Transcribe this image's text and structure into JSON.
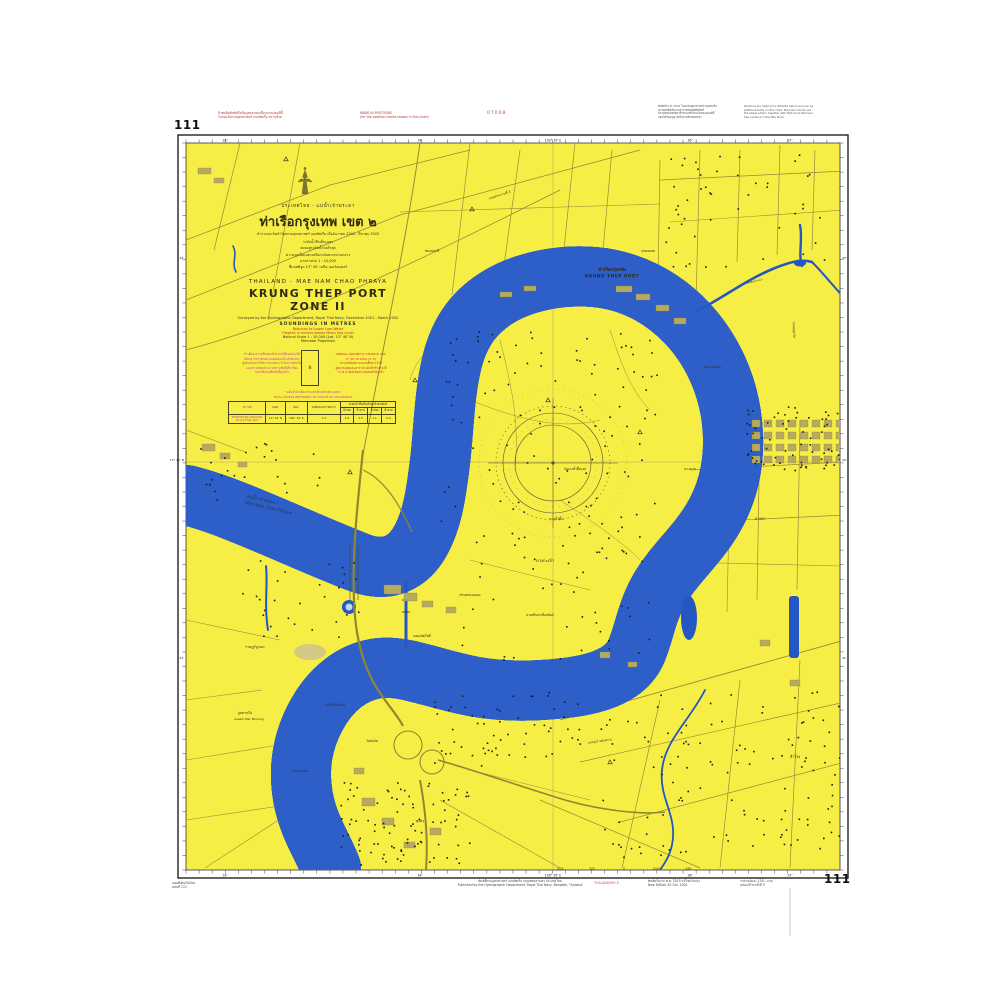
{
  "meta": {
    "chart_number": "111",
    "map_title": "Krung Thep Port Zone II nautical chart"
  },
  "margins": {
    "top": {
      "chart_number": "111",
      "red_note_left": [
        "ถ้าพบสิ่งพิมพ์หรือข้อมูลคลาดเคลื่อนจากแผนที่นี้",
        "โปรดแจ้งกรมอุทกศาสตร์ กองทัพเรือ ทราบด้วย"
      ],
      "red_note_right": [
        "MADE IN POSITIONS",
        "(for the position marks shown in this chart)"
      ],
      "magenta_code": "07008",
      "black_note_1": [
        "ลิขสิทธิ์ พ.ศ. 2545 โดยกรมอุทกศาสตร์ กองทัพเรือ",
        "สงวนลิขสิทธิ์ตามพระราชบัญญัติลิขสิทธิ์",
        "ห้ามคัดลอกหรือทำซ้ำส่วนหนึ่งส่วนใดของแผนที่นี้",
        "ก่อนได้รับอนุญาตเป็นลายลักษณ์อักษร"
      ],
      "black_note_2": [
        "Positions are referred to WGS-84 datum and can be",
        "plotted directly on this chart. Mariners should use",
        "the latest edition together with Notices to Mariners.",
        "See cautions in the title block."
      ]
    },
    "bottom": {
      "left": [
        "แผนที่เดินเรือไทย",
        "ฉบับที่ 111"
      ],
      "center": [
        "พิมพ์ที่กรมอุทกศาสตร์ กองทัพเรือ กรุงเทพมหานคร ประเทศไทย",
        "Published by the Hydrographic Department, Royal Thai Navy, Bangkok, Thailand"
      ],
      "magenta_code": "TH4-AN0099-5",
      "note_1": [
        "พิมพ์ครั้งแรก พ.ศ. 2515 แก้ไขปรับปรุง",
        "New Edition 30 Oct. 2002"
      ],
      "note_2": [
        "ราคาฉบับละ 150.- บาท",
        "ฉบับแก้ไข ครั้งที่ 5"
      ],
      "chart_number": "111"
    }
  },
  "title_block": {
    "thai_region": "ประเทศไทย - แม่น้ำเจ้าพระยา",
    "thai_title": "ท่าเรือกรุงเทพ เขต ๒",
    "thai_subtitle": "สำรวจและจัดทำโดยกรมอุทกศาสตร์ กองทัพเรือ เมื่อธันวาคม 2544 - มีนาคม 2545",
    "thai_lines": [
      "ระดับน้ำลึกเป็นเมตร",
      "ลดลงสู่ระดับน้ำลงต่ำสุด",
      "ความสูงเป็นเมตรเหนือระดับทะเลปานกลาง",
      "มาตราส่วน 1 : 10,000",
      "ที่แลตติจูด 13° 40' เหนือ  เมอร์เคเตอร์"
    ],
    "en_region": "THAILAND - MAE NAM CHAO PHRAYA",
    "en_title": "KRUNG THEP PORT ZONE II",
    "en_surveyed": "Surveyed by the Hydrographic Department, Royal Thai Navy, December 2001 - March 2002",
    "en_soundings": "SOUNDINGS IN METRES",
    "en_red_1": "Reduced to Lower Low Water",
    "en_red_2": "Heights in metres above Mean Sea Level",
    "en_scale": "Natural Scale 1 : 10,000 (Lat. 13° 40' N)",
    "en_projection": "Mercator Projection"
  },
  "caution_block": {
    "magenta_left": [
      "คำเตือน ความลึกของน้ำอาจเปลี่ยนแปลงได้",
      "เนื่องจากการตกตะกอนของแม่น้ำเจ้าพระยา",
      "ผู้เดินเรือควรใช้ความระมัดระวังในการเดินเรือ",
      "และตรวจสอบประกาศชาวเรือที่เกี่ยวข้อง",
      "ก่อนใช้แผนที่ฉบับนี้ทุกครั้ง"
    ],
    "red_right": [
      "ANNUAL  MAGNETIC  CHANGE  VAR.",
      "0° 35' W 2002  (2' E)",
      "ค่าแปรผันสนามแม่เหล็กประจำปี",
      "ดูหมายเหตุและตารางระดับน้ำข้างล่างนี้",
      "ระวัง สายเคเบิลและท่อลอดใต้แม่น้ำ"
    ],
    "magenta_caption_1": "ระดับน้ำอ้างอิงจากระดับน้ำลงต่ำสุด (เมตร)",
    "magenta_caption_2": "TIDAL LEVELS REFERRED TO DATUM OF SOUNDINGS"
  },
  "tide_table": {
    "headers_row1": [
      "สถานที่",
      "แลต.",
      "ลอง.",
      "ระดับทะเลปานกลาง",
      "ระดับน้ำขึ้นเต็มที่และน้ำลงเต็มที่"
    ],
    "headers_row2": [
      "น้ำเกิด",
      "น้ำตาย",
      "น้ำเกิด",
      "น้ำตาย"
    ],
    "row": [
      "ท่าเรือกรุงเทพ (คลองเตย) Krung Thep Port",
      "13° 42' N",
      "100° 34' E",
      "1.9",
      "2.8",
      "2.2",
      "1.1",
      "0.4"
    ]
  },
  "scale_bar": {
    "label_left": "มาตราส่วน 1 : 10,000",
    "ticks": [
      "1000",
      "500",
      "0",
      "1000",
      "เมตร"
    ]
  },
  "frame_ticks": {
    "top": [
      [
        225,
        "33'"
      ],
      [
        420,
        "34'"
      ],
      [
        553,
        "100° 35' E"
      ],
      [
        690,
        "36'"
      ],
      [
        790,
        "37'"
      ]
    ],
    "bottom": [
      [
        225,
        "33'"
      ],
      [
        420,
        "34'"
      ],
      [
        553,
        "100° 35' E"
      ],
      [
        690,
        "36'"
      ],
      [
        790,
        "37'"
      ]
    ],
    "left": [
      [
        260,
        "43'"
      ],
      [
        462,
        "13° 42' N"
      ],
      [
        660,
        "41'"
      ]
    ],
    "right": [
      [
        260,
        "43'"
      ],
      [
        462,
        "42'"
      ],
      [
        660,
        "41'"
      ]
    ]
  },
  "map_labels": [
    {
      "t": "ท่าเรือกรุงเทพ",
      "x": 612,
      "y": 271,
      "s": 4.6,
      "b": 1
    },
    {
      "t": "KRUNG THEP PORT",
      "x": 612,
      "y": 277.5,
      "s": 4.4,
      "b": 1,
      "sp": 0.5
    },
    {
      "t": "แม่น้ำเจ้าพระยา",
      "x": 262,
      "y": 501,
      "s": 4.6,
      "r": 13,
      "c": "#24304a"
    },
    {
      "t": "Mae Nam Chao Phraya",
      "x": 268,
      "y": 509,
      "s": 4.2,
      "r": 13,
      "i": 1,
      "c": "#24304a"
    },
    {
      "t": "บางกะเจ้า",
      "x": 545,
      "y": 562,
      "s": 4.2
    },
    {
      "t": "ตำบลทรงคนอง",
      "x": 470,
      "y": 596,
      "s": 3.2
    },
    {
      "t": "คลองลัดโพธิ์",
      "x": 422,
      "y": 637,
      "s": 3.2
    },
    {
      "t": "พระประแดง",
      "x": 335,
      "y": 706,
      "s": 3.8
    },
    {
      "t": "วัดบางน้ำผึ้งนอก",
      "x": 575,
      "y": 470,
      "s": 3.2
    },
    {
      "t": "บางน้ำผึ้ง",
      "x": 556,
      "y": 520,
      "s": 3.4
    },
    {
      "t": "ช่องนนทรี",
      "x": 432,
      "y": 252,
      "s": 3.4
    },
    {
      "t": "ถนนพระรามที่ 3",
      "x": 500,
      "y": 196,
      "s": 3.2,
      "r": -18
    },
    {
      "t": "คลองเตย",
      "x": 648,
      "y": 252,
      "s": 3.4
    },
    {
      "t": "ถนนสุขุมวิท",
      "x": 793,
      "y": 330,
      "s": 3.2,
      "r": 88
    },
    {
      "t": "บางนา",
      "x": 760,
      "y": 520,
      "s": 3.8
    },
    {
      "t": "สำโรง",
      "x": 795,
      "y": 758,
      "s": 3.8
    },
    {
      "t": "ราษฎร์บูรณะ",
      "x": 255,
      "y": 648,
      "s": 3.6
    },
    {
      "t": "บางปะกอก",
      "x": 300,
      "y": 772,
      "s": 3.4
    },
    {
      "t": "ทุ่งครุ",
      "x": 420,
      "y": 822,
      "s": 3.6
    },
    {
      "t": "บางจาก",
      "x": 690,
      "y": 470,
      "s": 3.4
    },
    {
      "t": "อู่ทหารเรือ",
      "x": 245,
      "y": 714,
      "s": 3.2
    },
    {
      "t": "Asiatic Pier Mooring",
      "x": 249,
      "y": 720,
      "s": 3.0,
      "i": 1
    },
    {
      "t": "วัดคันลัด",
      "x": 372,
      "y": 742,
      "s": 3.0
    },
    {
      "t": "สวนศรีนครเขื่อนขันธ์",
      "x": 540,
      "y": 616,
      "s": 3.0
    },
    {
      "t": "คลองบางนา",
      "x": 755,
      "y": 282,
      "s": 3.0,
      "r": -14
    },
    {
      "t": "ถนนปู่เจ้าสมิงพราย",
      "x": 600,
      "y": 742,
      "s": 3.0,
      "r": -8
    },
    {
      "t": "วัดบางนานอก",
      "x": 712,
      "y": 368,
      "s": 3.0
    }
  ],
  "colors": {
    "land": "#f7ee45",
    "river_edge": "#2e5fc9",
    "river_mid": "#7fa9e0",
    "river_light": "#bdd9f0",
    "river_center": "#edf6fc",
    "canal": "#2456c4",
    "road": "#948c3a",
    "building": "#b6aa5e",
    "magenta": "#c93a9e",
    "red_note": "#b23333"
  }
}
